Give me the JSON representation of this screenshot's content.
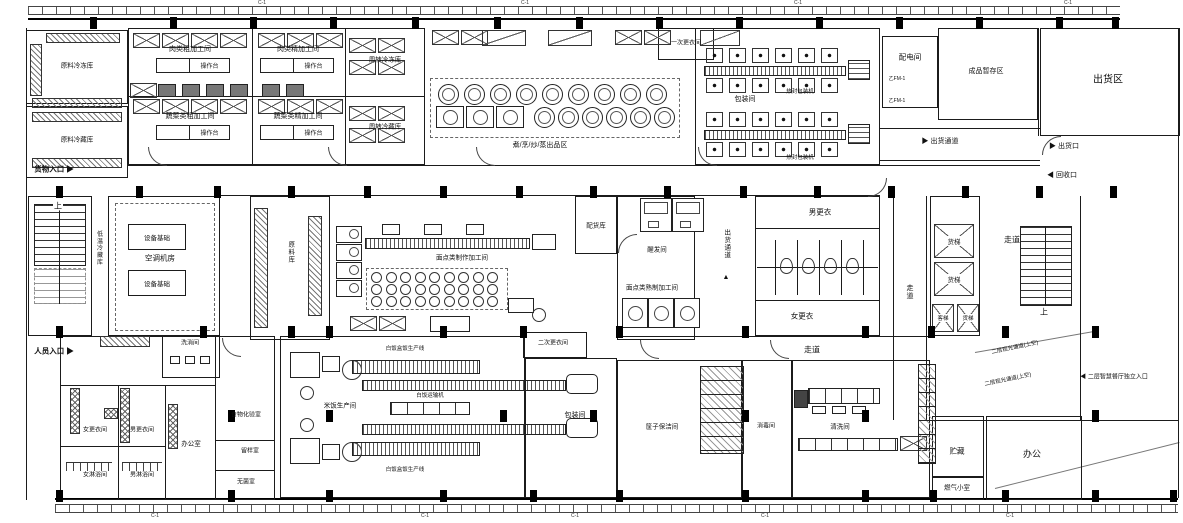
{
  "rooms": {
    "raw_freezer": "原料冷冻库",
    "raw_chiller": "原料冷藏库",
    "meat_rough": "肉类粗加工间",
    "meat_fine": "肉类精加工间",
    "veg_rough": "蔬菜类粗加工间",
    "veg_fine": "蔬菜类精加工间",
    "turnover_freezer": "周转冷冻库",
    "turnover_chiller": "周转冷藏库",
    "first_changing": "一次更衣间",
    "packing": "包装间",
    "power": "配电间",
    "finished_staging": "成品暂存区",
    "shipping_area": "出货区",
    "lowtemp_storage": "低温冷藏库",
    "ac_room": "空调机房",
    "raw_storage": "原料库",
    "goods_storage": "配货库",
    "proofing": "醒发间",
    "noodle_making": "面点类制作加工间",
    "noodle_cooking": "面点类熟制加工间",
    "men_changing_hall": "男更衣",
    "women_changing_hall": "女更衣",
    "corridor": "走道",
    "freight_elevator": "货梯",
    "passenger_elevator": "客梯",
    "wash_sanitize": "洗消间",
    "women_changing": "女更衣间",
    "men_changing": "男更衣间",
    "women_shower": "女淋浴间",
    "men_shower": "男淋浴间",
    "office_room": "办公室",
    "food_lab": "食物化验室",
    "sample_room": "留样室",
    "sterile_room": "无菌室",
    "rice_production": "米饭生产间",
    "second_changing": "二次更衣间",
    "basket_cleaning": "筐子保洁间",
    "disinfection": "消毒间",
    "washing": "清洗间",
    "storage": "贮藏",
    "office": "办公",
    "gas_room": "燃气小室"
  },
  "zones": {
    "cooking": "煮/烹/炒/蒸出品区",
    "observation_note": "二层观光通道(上空)"
  },
  "annotations": {
    "goods_entrance": "货物入口",
    "personnel_entrance": "人员入口",
    "shipping_passage": "出货通道",
    "shipping_port": "出货口",
    "recycle_port": "回收口",
    "second_floor_entrance": "二层智慧餐厅独立入口",
    "up": "上"
  },
  "equipment": {
    "operating_table": "操作台",
    "equip_base": "设备基础",
    "heat_seal": "热封包装机",
    "rice_line": "白饭盒饭生产线",
    "rice_conveyor": "白饭运输机",
    "door_code": "乙FM-1"
  },
  "icons": {
    "arrow_right": "▶",
    "arrow_left": "◀",
    "arrow_up": "▲"
  },
  "grid": {
    "tick": "C-1"
  }
}
